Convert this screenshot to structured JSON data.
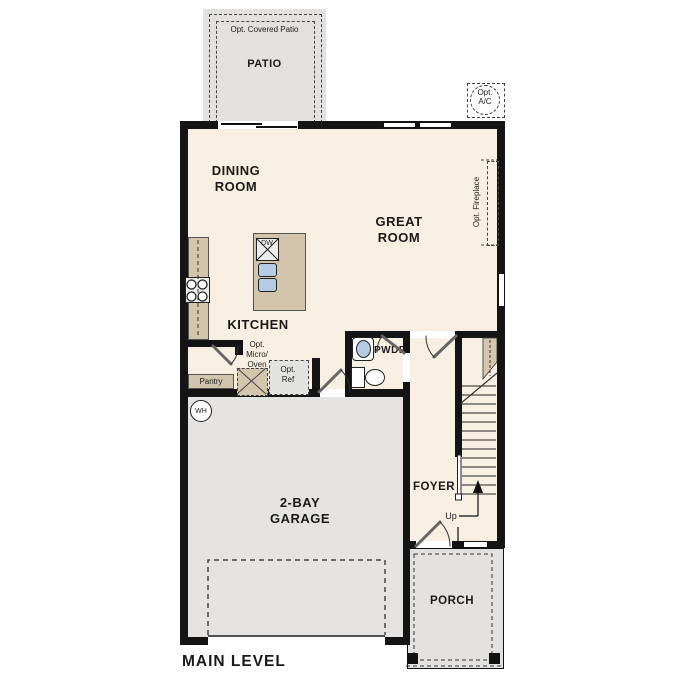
{
  "plan": {
    "level_label": "MAIN LEVEL",
    "rooms": {
      "patio": {
        "name": "PATIO",
        "option": "Opt. Covered Patio"
      },
      "dining": {
        "line1": "DINING",
        "line2": "ROOM"
      },
      "great": {
        "line1": "GREAT",
        "line2": "ROOM"
      },
      "kitchen": {
        "name": "KITCHEN"
      },
      "pantry": {
        "name": "Pantry"
      },
      "powder": {
        "name": "PWDR"
      },
      "foyer": {
        "name": "FOYER"
      },
      "garage": {
        "line1": "2-BAY",
        "line2": "GARAGE"
      },
      "porch": {
        "name": "PORCH"
      }
    },
    "features": {
      "micro": {
        "line1": "Opt.",
        "line2": "Micro/",
        "line3": "Oven"
      },
      "ref": {
        "line1": "Opt.",
        "line2": "Ref"
      },
      "ac": {
        "line1": "Opt.",
        "line2": "A/C"
      },
      "fireplace": {
        "label": "Opt. Fireplace"
      },
      "dishwasher": "DW",
      "water_heater": "WH",
      "stairs_direction": "Up"
    },
    "colors": {
      "cream": "#f7efe2",
      "tan": "#d2c5ab",
      "grayarea": "#e2e1df",
      "garage": "#e4e3e1",
      "blue": "#b3cbe3",
      "wall": "#141414",
      "appliance": "#ededed"
    }
  }
}
